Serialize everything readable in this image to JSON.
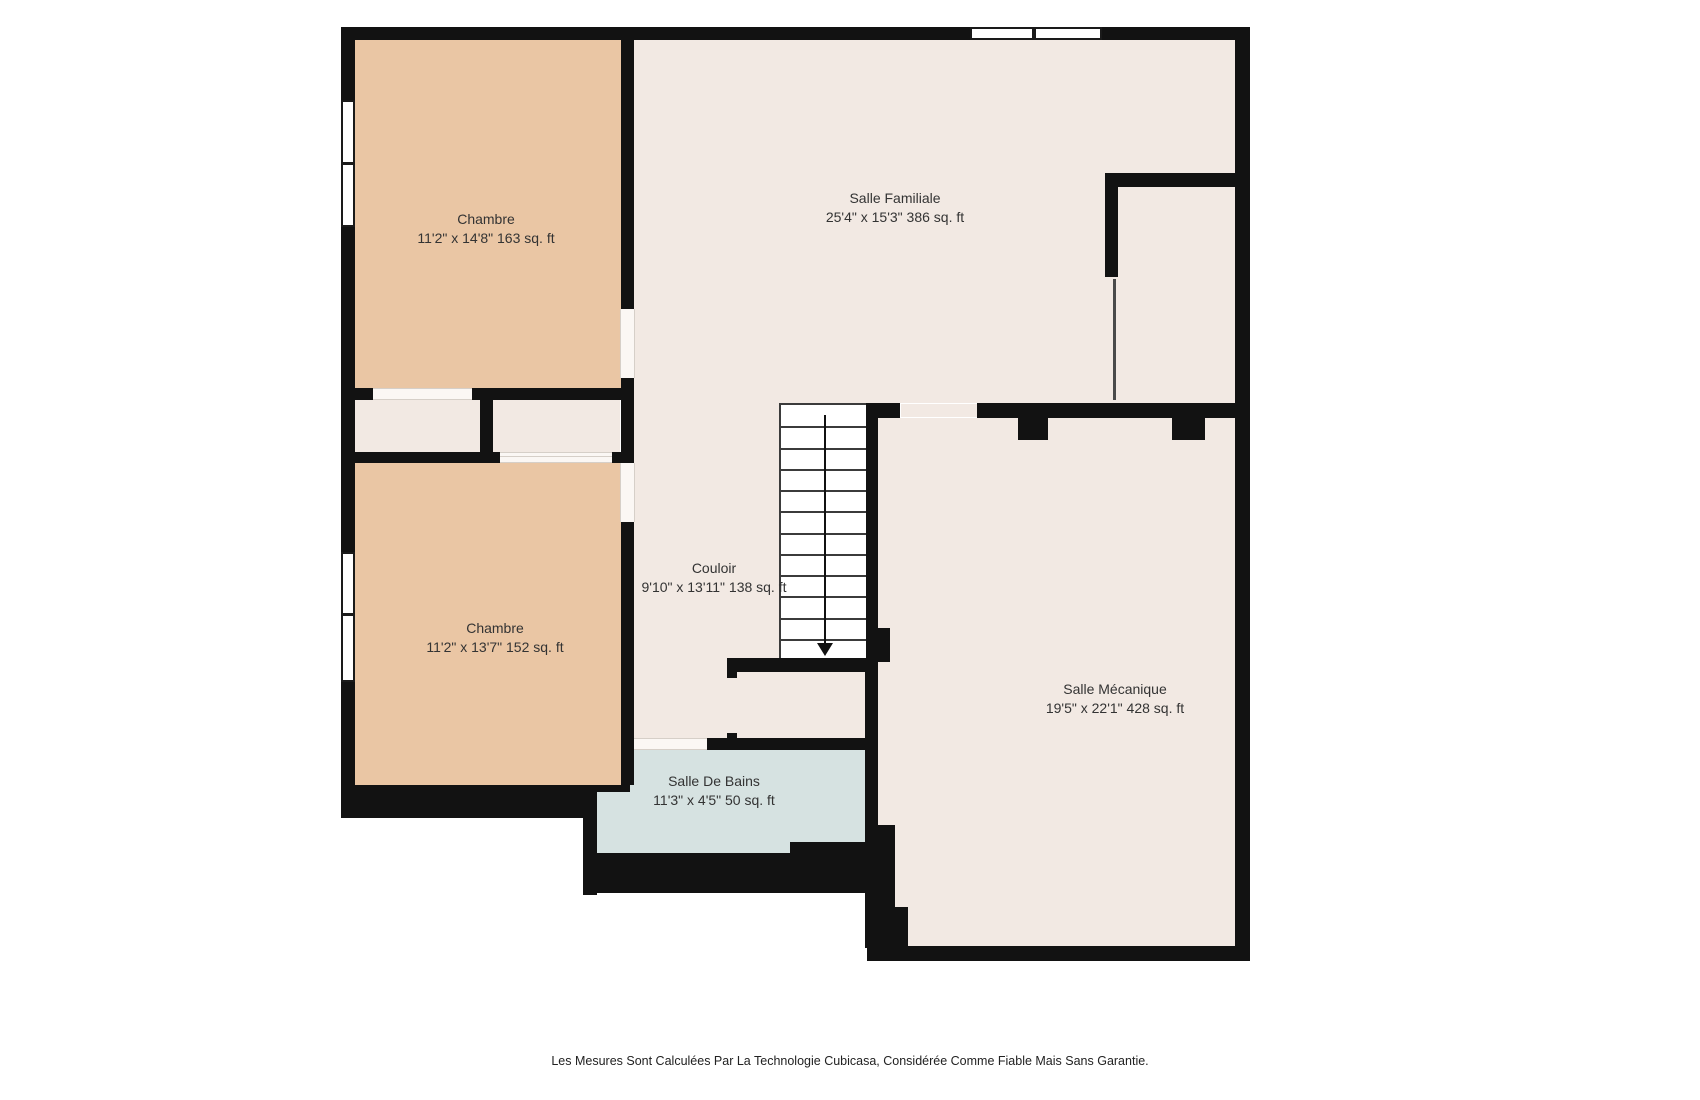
{
  "colors": {
    "wall": "#121212",
    "floor": "#F2E9E3",
    "bedroom_floor": "#EAC6A4",
    "bathroom_floor": "#D6E2E1",
    "stair_line": "#3b3b3b",
    "label_text": "#333333"
  },
  "rooms": [
    {
      "id": "chambre-1",
      "name": "Chambre",
      "dims": "11'2\" x 14'8\" 163 sq. ft"
    },
    {
      "id": "salle-familiale",
      "name": "Salle Familiale",
      "dims": "25'4\" x 15'3\" 386 sq. ft"
    },
    {
      "id": "couloir",
      "name": "Couloir",
      "dims": "9'10\" x 13'11\" 138 sq. ft"
    },
    {
      "id": "chambre-2",
      "name": "Chambre",
      "dims": "11'2\" x 13'7\" 152 sq. ft"
    },
    {
      "id": "salle-de-bains",
      "name": "Salle De Bains",
      "dims": "11'3\" x 4'5\" 50 sq. ft"
    },
    {
      "id": "salle-mecanique",
      "name": "Salle Mécanique",
      "dims": "19'5\" x 22'1\" 428 sq. ft"
    }
  ],
  "stairs": {
    "steps": 12,
    "direction": "down"
  },
  "footer": {
    "disclaimer": "Les Mesures Sont Calculées Par La Technologie Cubicasa, Considérée Comme Fiable Mais Sans Garantie."
  }
}
